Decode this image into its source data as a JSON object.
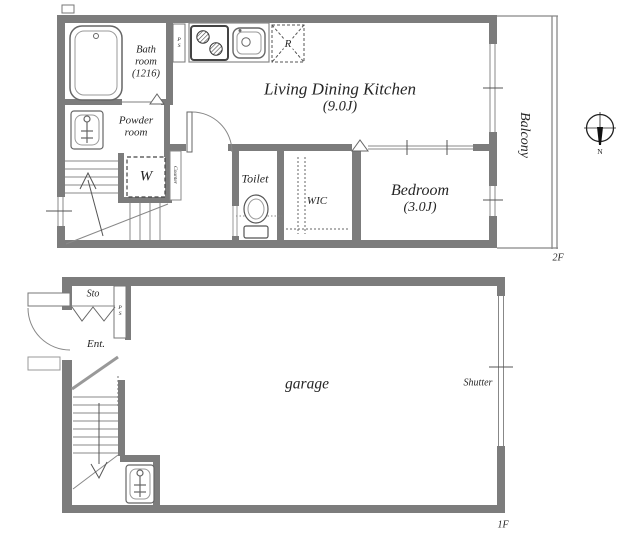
{
  "floor2": {
    "label": "2F",
    "bathroom": {
      "line1": "Bath",
      "line2": "room",
      "line3": "(1216)"
    },
    "powder_room": {
      "line1": "Powder",
      "line2": "room"
    },
    "ldk": {
      "line1": "Living Dining Kitchen",
      "line2": "(9.0J)"
    },
    "toilet": "Toilet",
    "wic": "WIC",
    "bedroom": {
      "line1": "Bedroom",
      "line2": "(3.0J)"
    },
    "balcony": "Balcony",
    "washer": "W",
    "fridge": "R",
    "counter": "Counter",
    "pipe_space": "PS"
  },
  "floor1": {
    "label": "1F",
    "storage": "Sto",
    "entrance": "Ent.",
    "garage": "garage",
    "shutter": "Shutter",
    "pipe_space": "PS"
  },
  "compass": {
    "north": "N"
  },
  "colors": {
    "wall": "#7c7c7c",
    "line": "#888888",
    "text": "#262626",
    "background": "#ffffff"
  }
}
